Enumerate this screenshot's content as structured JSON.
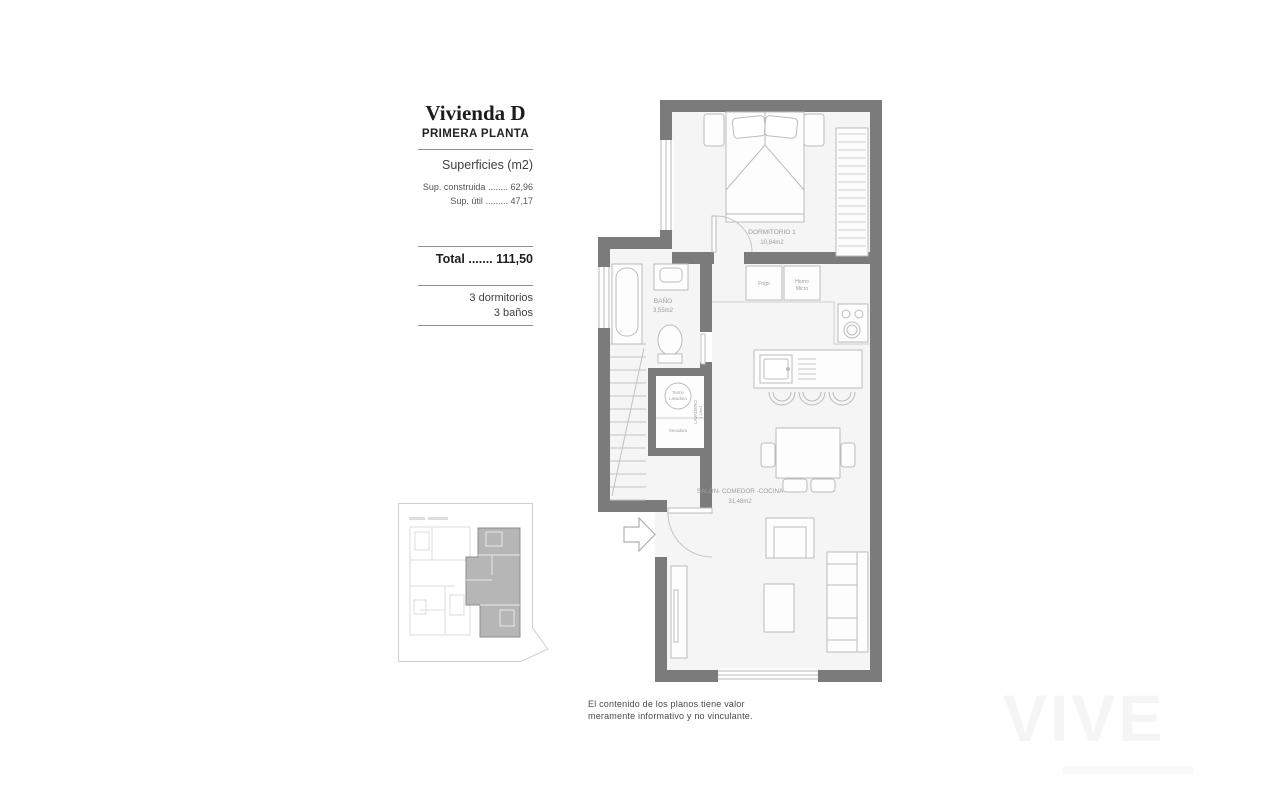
{
  "panel": {
    "title": "Vivienda D",
    "subtitle": "PRIMERA PLANTA",
    "surfaces_heading": "Superficies (m2)",
    "surface_rows": [
      {
        "label": "Sup. construida",
        "leader": "........",
        "value": "62,96"
      },
      {
        "label": "Sup. útil",
        "leader": ".........",
        "value": "47,17"
      }
    ],
    "total": {
      "label": "Total",
      "leader": ".......",
      "value": "111,50"
    },
    "features": [
      "3 dormitorios",
      "3 baños"
    ]
  },
  "plan": {
    "bedroom_name": "DORMITORIO 1",
    "bedroom_area": "10,84m2",
    "bath_name": "BAÑO",
    "bath_area": "3,55m2",
    "living_name": "SALÓN- COMEDOR -COCINA",
    "living_area": "31,48m2",
    "laundry_name": "LAVADERO",
    "laundry_area": "1,15m2",
    "fridge": "Frigo",
    "oven_line1": "Horno",
    "oven_line2": "Micro",
    "washer_line1": "Termo",
    "washer_line2": "Lavadora",
    "dryer": "Secadora"
  },
  "disclaimer": {
    "line1": "El contenido de los planos tiene valor",
    "line2": "meramente informativo y no vinculante."
  },
  "watermark": "VIVE",
  "colors": {
    "wall": "#7b7b7b",
    "floor": "#f5f5f5",
    "furniture_line": "#bcbcbc",
    "label": "#9d9d9d"
  }
}
